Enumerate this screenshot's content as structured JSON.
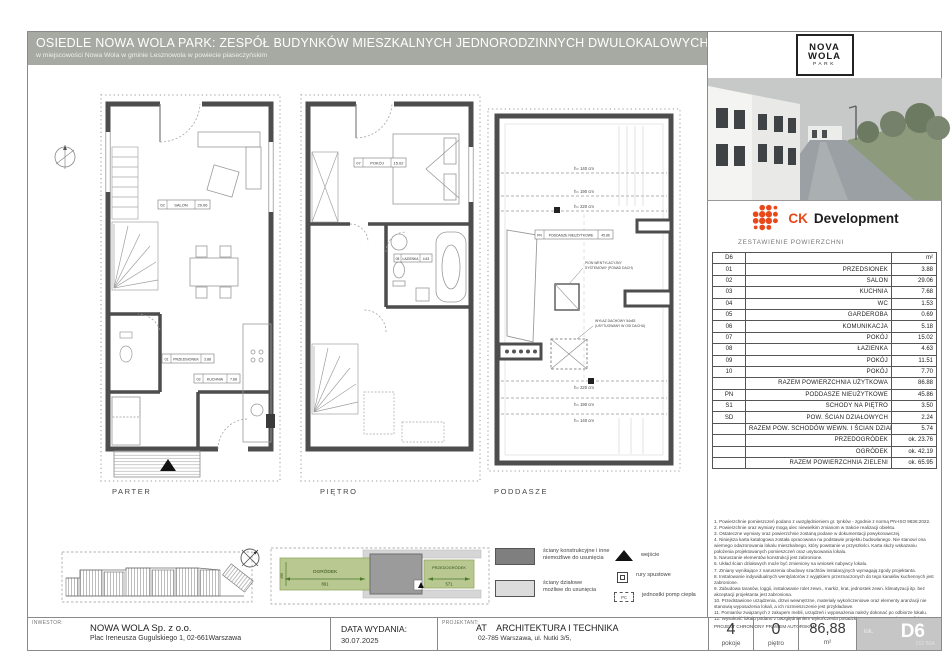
{
  "header": {
    "title": "OSIEDLE NOWA WOLA PARK: ZESPÓŁ BUDYNKÓW MIESZKALNYCH JEDNORODZINNYCH DWULOKALOWYCH",
    "subtitle": "w miejscowości Nowa Wola w gminie Lesznowola w powiecie piaseczyńskim"
  },
  "plans": {
    "parter": {
      "label": "PARTER",
      "rooms": {
        "salon": {
          "code": "02",
          "name": "SALON",
          "area": "29.06"
        },
        "kuchnia": {
          "code": "03",
          "name": "KUCHNIA",
          "area": "7.68"
        },
        "przedsionek": {
          "code": "01",
          "name": "PRZEDSIONEK",
          "area": "3.88"
        }
      }
    },
    "pietro": {
      "label": "PIĘTRO",
      "rooms": {
        "pokoj": {
          "code": "07",
          "name": "POKÓJ",
          "area": "15.02"
        },
        "lazienka": {
          "code": "08",
          "name": "ŁAZIENKA",
          "area": "4.63"
        }
      }
    },
    "poddasze": {
      "label": "PODDASZE",
      "pn_box": {
        "code": "PN",
        "name": "PODDASZE NIEUŻYTKOWE",
        "area": "45.86"
      },
      "heights_top": [
        "h= 140 cm",
        "h= 190 cm",
        "h= 220 cm"
      ],
      "heights_bottom": [
        "h= 220 cm",
        "h= 190 cm",
        "h= 140 cm"
      ],
      "notes": {
        "chimney_1": "PION WENTYLACYJNY",
        "chimney_2": "SYSTEMOWY (PONAD DACH)",
        "hatch_1": "WYŁAZ DACHOWY 54x83",
        "hatch_2": "(USYTUOWANY W OSI DACHU)"
      }
    }
  },
  "siteplan": {
    "ogrodek_label": "OGRÓDEK",
    "ogrodek_dim": "861",
    "przedogrodek_label": "PRZEDOGRÓDEK",
    "przedogrodek_dim": "571",
    "depth_dim": "490"
  },
  "legend": {
    "structural_1": "ściany konstrukcyjne i inne",
    "structural_2": "niemożliwe do usunięcia",
    "partition_1": "ściany działowe",
    "partition_2": "możliwe do usunięcia",
    "entrance": "wejście",
    "pipes": "rury spustowe",
    "heatpump": "jednostki pomp ciepła",
    "pc": "PC"
  },
  "sidebar": {
    "logo": {
      "l1": "NOVA",
      "l2": "WOLA",
      "l3": "PARK"
    },
    "brand": {
      "ck": "CK",
      "dev": "Development"
    },
    "table": {
      "title": "ZESTAWIENIE POWIERZCHNI",
      "header": {
        "code": "D6",
        "name": "",
        "unit": "m²"
      },
      "rows": [
        {
          "code": "01",
          "name": "PRZEDSIONEK",
          "value": "3.88"
        },
        {
          "code": "02",
          "name": "SALON",
          "value": "29.06"
        },
        {
          "code": "03",
          "name": "KUCHNIA",
          "value": "7.68"
        },
        {
          "code": "04",
          "name": "WC",
          "value": "1.53"
        },
        {
          "code": "05",
          "name": "GARDEROBA",
          "value": "0.69"
        },
        {
          "code": "06",
          "name": "KOMUNIKACJA",
          "value": "5.18"
        },
        {
          "code": "07",
          "name": "POKÓJ",
          "value": "15.02"
        },
        {
          "code": "08",
          "name": "ŁAZIENKA",
          "value": "4.63"
        },
        {
          "code": "09",
          "name": "POKÓJ",
          "value": "11.51"
        },
        {
          "code": "10",
          "name": "POKÓJ",
          "value": "7.70"
        },
        {
          "code": "",
          "name": "RAZEM POWIERZCHNIA UŻYTKOWA",
          "value": "86.88"
        },
        {
          "code": "PN",
          "name": "PODDASZE NIEUŻYTKOWE",
          "value": "45.86"
        },
        {
          "code": "S1",
          "name": "SCHODY NA PIĘTRO",
          "value": "3.50"
        },
        {
          "code": "SD",
          "name": "POW. ŚCIAN DZIAŁOWYCH",
          "value": "2.24"
        },
        {
          "code": "",
          "name": "RAZEM POW. SCHODÓW WEWN. I ŚCIAN DZIAŁ.",
          "value": "5.74"
        },
        {
          "code": "",
          "name": "PRZEDOGRÓDEK",
          "value": "ok. 23.76"
        },
        {
          "code": "",
          "name": "OGRÓDEK",
          "value": "ok. 42.19"
        },
        {
          "code": "",
          "name": "RAZEM POWIERZCHNIA ZIELENI",
          "value": "ok. 65.95"
        }
      ]
    },
    "notes": [
      "Powierzchnie pomieszczeń podano z uwzględnieniem gr. tynków - zgodnie z normą PN-ISO 9836:2022.",
      "Powierzchnie oraz wymiary mogą ulec niewielkim zmianom w trakcie realizacji obiektu.",
      "Ostateczne wymiary oraz powierzchnie zostaną podane w dokumentacji powykonawczej.",
      "Niniejsza karta katalogowa została opracowana na podstawie projektu budowlanego. Nie stanowi ona wiernego odwzorowania lokalu mieszkalnego, który powstanie w przyszłości. Karta służy wskazaniu położenia projektowanych pomieszczeń oraz usytuowania lokalu.",
      "Naruszanie elementów konstrukcji jest zabronione.",
      "Układ ścian działowych może być zmieniony na wniosek nabywcy lokalu.",
      "Zmiany wynikające z naruszenia obudowy szachtów instalacyjnych wymagają zgody projektanta.",
      "Instalowanie indywidualnych wentylatorów z wyjątkiem przeznaczonych do tego kanałów kuchennych jest zabronione.",
      "Zabudowa tarasów, loggii, instalowanie rolet zewn., markiz, krat, jednostek zewn. klimatyzacji itp. bez akceptacji projektanta jest zabroniona.",
      "Przedstawione urządzenia, drzwi wewnętrzne, materiały wykończeniowe oraz elementy aranżacji nie stanowią wyposażenia lokali, a ich rozmieszczenie jest przykładowe.",
      "Pomiarów związanych z zakupem mebli, urządzeń i wyposażenia należy dokonać po odbiorze lokalu.",
      "Wysokość lokalu podano z uwzględnieniem wykończenia posadzki o gr. 2 cm oraz tynku na suficie."
    ],
    "copyright": "PROJEKT CHRONIONY PRAWEM AUTORSKIM"
  },
  "footer": {
    "investor_label": "INWESTOR:",
    "investor_name": "NOWA WOLA Sp. z o.o.",
    "investor_address": "Plac Ireneusza Gugulskiego 1, 02-661Warszawa",
    "date_label": "DATA WYDANIA:",
    "date_value": "30.07.2025",
    "designer_label": "PROJEKTANT:",
    "designer_name": "AT    ARCHITEKTURA I TECHNIKA",
    "designer_address": "02-785 Warszawa,  ul. Nutki 3/5,",
    "stats": {
      "rooms_value": "4",
      "rooms_label": "pokoje",
      "floor_value": "0",
      "floor_label": "piętro",
      "area_value": "86,88",
      "area_label": "m²",
      "unit_prefix": "lok.",
      "unit_value": "D6",
      "unit_code": "Z02 B8A"
    }
  },
  "colors": {
    "accent_orange": "#e8491b",
    "header_bar": "#a6aaa2",
    "site_green": "#b9c890",
    "legend_dark": "#7f7f7f",
    "legend_light": "#dcdcdc"
  }
}
